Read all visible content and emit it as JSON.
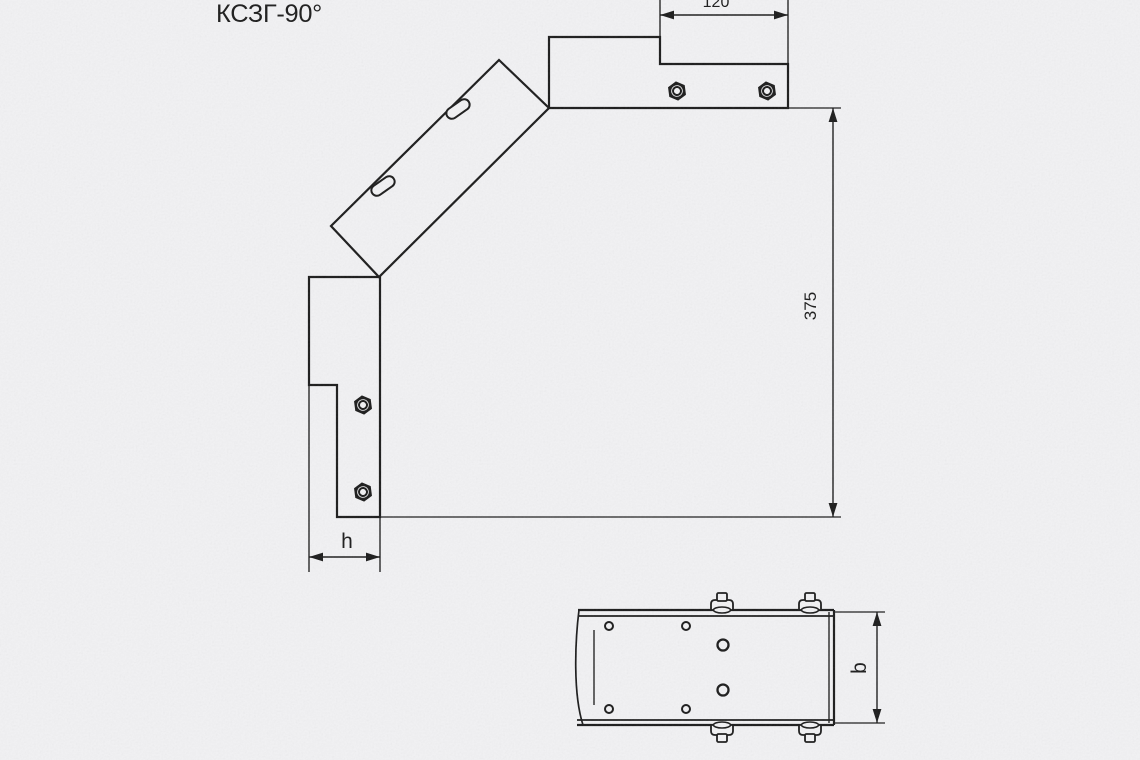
{
  "title": "КСЗГ-90°",
  "side_view": {
    "dim_plate_length": "120",
    "dim_height": "375",
    "dim_tray_height": "h"
  },
  "plan_view": {
    "dim_tray_width": "b"
  },
  "colors": {
    "line": "#1c1c1c",
    "background": "#f1f1f3"
  }
}
